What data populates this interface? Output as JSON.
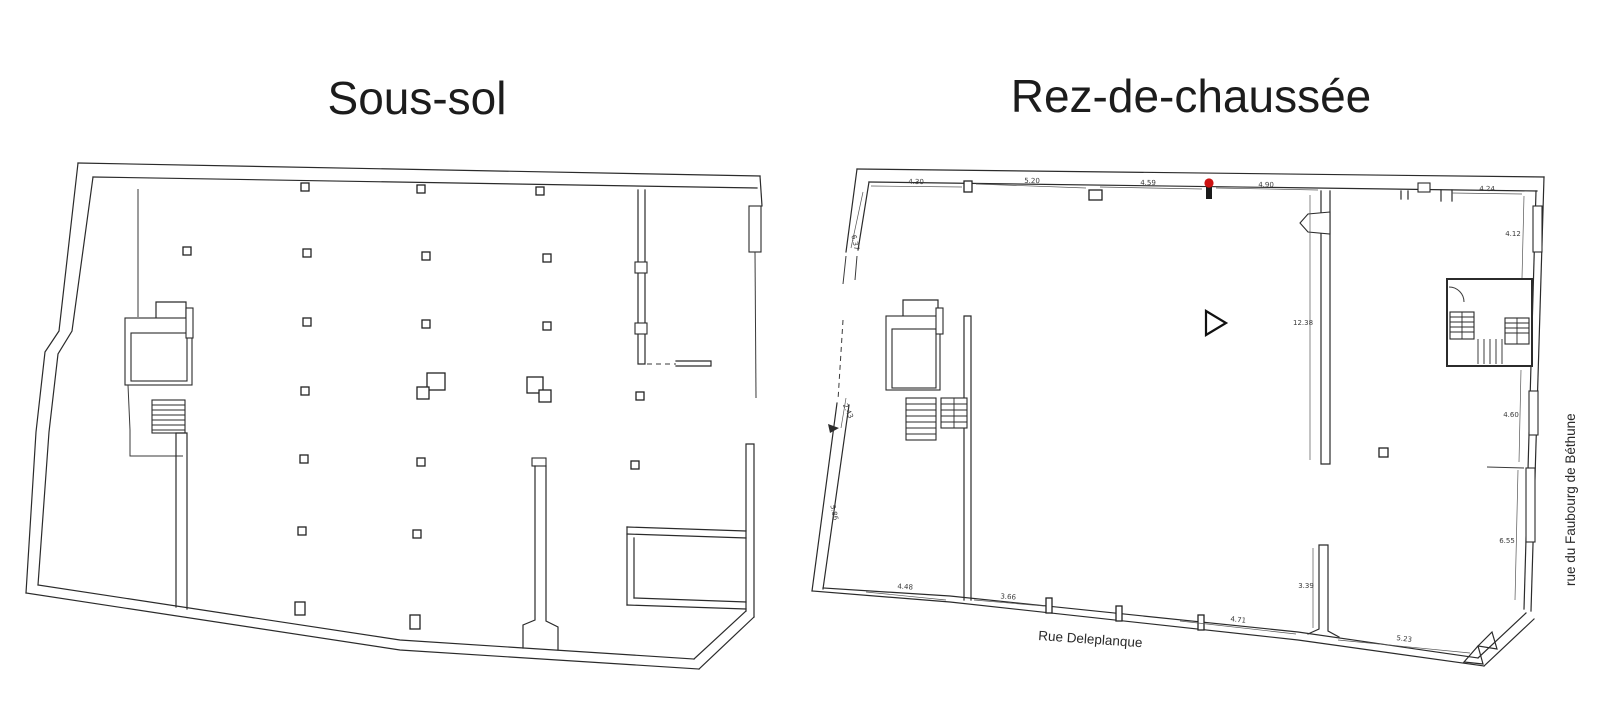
{
  "plans": {
    "left": {
      "title": "Sous-sol"
    },
    "right": {
      "title": "Rez-de-chaussée"
    }
  },
  "streets": {
    "bottom": "Rue Deleplanque",
    "side": "rue du Faubourg de Béthune"
  },
  "colors": {
    "wall": "#2b2b2b",
    "dim_text": "#3a3a3a",
    "marker_red": "#cc1111"
  },
  "marker": {
    "label": "red-survey-point",
    "color": "#cc1111"
  },
  "dimensions_m": [
    {
      "text": "4.30",
      "x": 916,
      "y": 184,
      "rot": 1
    },
    {
      "text": "5.20",
      "x": 1032,
      "y": 183,
      "rot": 1
    },
    {
      "text": "4.59",
      "x": 1148,
      "y": 185,
      "rot": 1
    },
    {
      "text": "4.90",
      "x": 1266,
      "y": 187,
      "rot": 1
    },
    {
      "text": "4.24",
      "x": 1487,
      "y": 191,
      "rot": 1
    },
    {
      "text": "6.37",
      "x": 853,
      "y": 243,
      "rot": 78
    },
    {
      "text": "12.38",
      "x": 1303,
      "y": 325,
      "rot": 0
    },
    {
      "text": "4.12",
      "x": 1513,
      "y": 236,
      "rot": 0
    },
    {
      "text": "4.60",
      "x": 1511,
      "y": 417,
      "rot": 0
    },
    {
      "text": "6.55",
      "x": 1507,
      "y": 543,
      "rot": 0
    },
    {
      "text": "3.39",
      "x": 1306,
      "y": 588,
      "rot": 0
    },
    {
      "text": "2.43",
      "x": 846,
      "y": 412,
      "rot": 65
    },
    {
      "text": "5.86",
      "x": 832,
      "y": 513,
      "rot": 78
    },
    {
      "text": "4.48",
      "x": 905,
      "y": 589,
      "rot": 4
    },
    {
      "text": "3.66",
      "x": 1008,
      "y": 599,
      "rot": 5
    },
    {
      "text": "4.71",
      "x": 1238,
      "y": 622,
      "rot": 6
    },
    {
      "text": "5.23",
      "x": 1404,
      "y": 641,
      "rot": 7
    }
  ]
}
